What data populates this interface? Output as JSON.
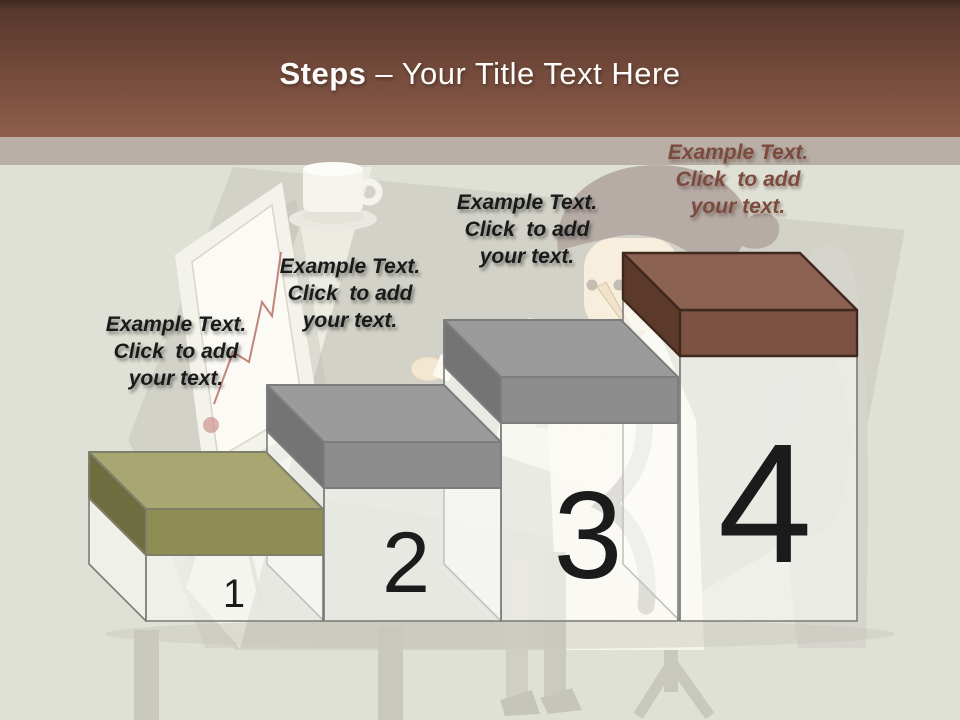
{
  "header": {
    "title_bold": "Steps",
    "title_rest": "– Your Title Text Here"
  },
  "colors": {
    "header_top": "#57382c",
    "header_bottom": "#8f5d4b",
    "strip": "#b9afa7",
    "background": "#e0e1d6",
    "title_color": "#fdfcfa",
    "number_color": "#1b1b1b",
    "body_fill": "rgba(253,253,251,0.55)",
    "body_outline": "#7b7b77",
    "label_dark": "#1a1a1a",
    "label_brown": "#7c4b3d"
  },
  "steps": [
    {
      "number": "1",
      "lines": [
        "Example Text.",
        "Click  to add",
        "your text."
      ],
      "lid": {
        "top": "#a8a772",
        "front": "#8e8d54",
        "side": "#6e6d3f",
        "outline": "#80806a"
      }
    },
    {
      "number": "2",
      "lines": [
        "Example Text.",
        "Click  to add",
        "your text."
      ],
      "lid": {
        "top": "#9b9b9b",
        "front": "#8d8d8d",
        "side": "#747474",
        "outline": "#7d7d7d"
      }
    },
    {
      "number": "3",
      "lines": [
        "Example Text.",
        "Click  to add",
        "your text."
      ],
      "lid": {
        "top": "#9b9b9b",
        "front": "#8d8d8d",
        "side": "#747474",
        "outline": "#7d7d7d"
      }
    },
    {
      "number": "4",
      "lines": [
        "Example Text.",
        "Click  to add",
        "your text."
      ],
      "lid": {
        "top": "#8b6151",
        "front": "#7c5342",
        "side": "#5b392b",
        "outline": "#3f281d"
      }
    }
  ],
  "background_icons": [
    "desk-icon",
    "easel-leg-icon",
    "picture-frame-icon",
    "line-chart-icon",
    "coffee-cup-icon",
    "calculator-icon",
    "person-icon",
    "necktie-icon",
    "office-chair-icon",
    "table-leg-icon"
  ]
}
